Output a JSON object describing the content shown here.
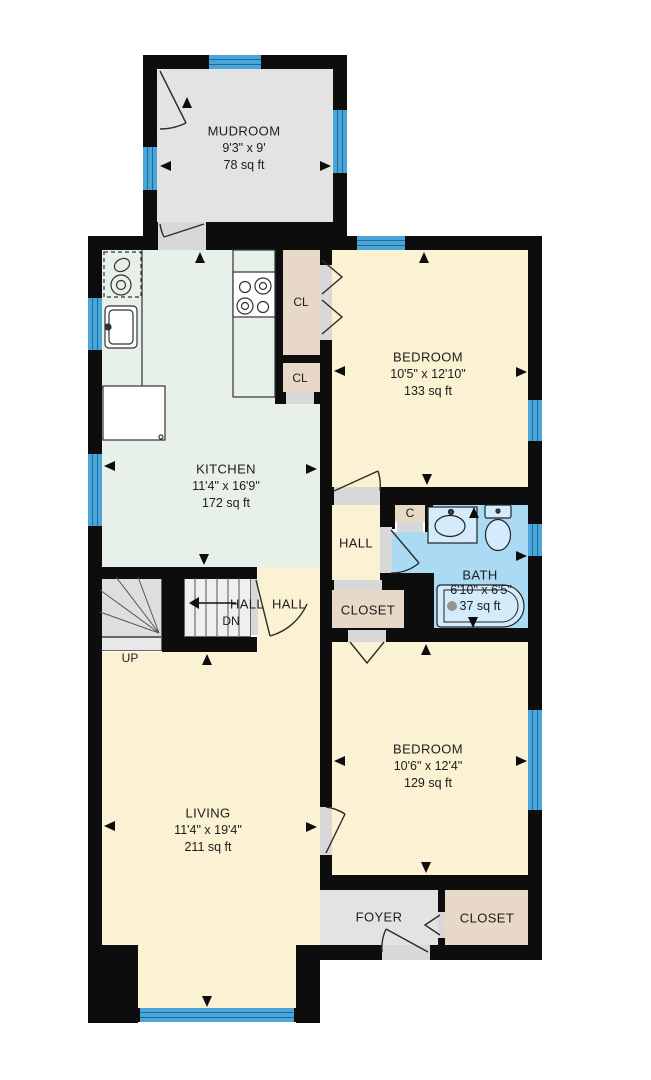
{
  "plan": {
    "colors": {
      "wall": "#0d0d0d",
      "window": "#4aa5d8",
      "window_line": "#1d6b96",
      "floor_gray": "#e3e3e3",
      "floor_green": "#e7f0e9",
      "floor_cream": "#fbf1d3",
      "floor_tan": "#e7d8c7",
      "floor_blue": "#abdaf4",
      "fixture_blue": "#d3ebfa",
      "door_gray": "#d8d8d8",
      "stair_gray": "#dedede",
      "text": "#1c1c1c"
    },
    "rooms": [
      {
        "name": "MUDROOM",
        "dims": "9'3\" x 9'",
        "area": "78 sq ft"
      },
      {
        "name": "KITCHEN",
        "dims": "11'4\" x 16'9\"",
        "area": "172 sq ft"
      },
      {
        "name": "BEDROOM",
        "dims": "10'5\" x 12'10\"",
        "area": "133 sq ft"
      },
      {
        "name": "BATH",
        "dims": "6'10\" x 6'5\"",
        "area": "37 sq ft"
      },
      {
        "name": "LIVING",
        "dims": "11'4\" x 19'4\"",
        "area": "211 sq ft"
      },
      {
        "name": "BEDROOM",
        "dims": "10'6\" x 12'4\"",
        "area": "129 sq ft"
      },
      {
        "name": "FOYER"
      },
      {
        "name": "CLOSET"
      },
      {
        "name": "CLOSET"
      },
      {
        "name": "HALL"
      },
      {
        "name": "HALL"
      },
      {
        "name": "HALL"
      }
    ],
    "small_labels": {
      "closet_upper": "CL",
      "closet_lower": "CL",
      "closet_small": "C",
      "stairs_up": "UP",
      "stairs_down": "DN"
    }
  }
}
